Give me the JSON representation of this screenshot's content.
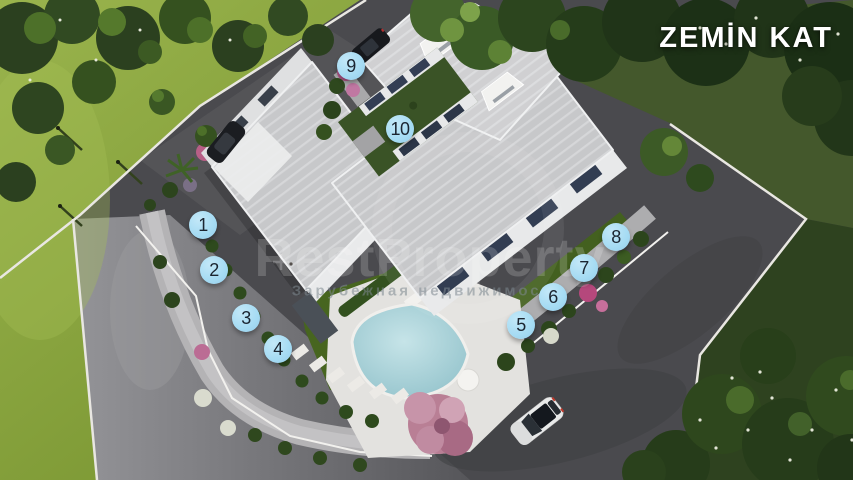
{
  "title": "ZEMİN KAT",
  "watermark": {
    "brand": "RestProperty",
    "tagline": "Зарубежная недвижимость"
  },
  "markers": [
    {
      "id": 1,
      "label": "1"
    },
    {
      "id": 2,
      "label": "2"
    },
    {
      "id": 3,
      "label": "3"
    },
    {
      "id": 4,
      "label": "4"
    },
    {
      "id": 5,
      "label": "5"
    },
    {
      "id": 6,
      "label": "6"
    },
    {
      "id": 7,
      "label": "7"
    },
    {
      "id": 8,
      "label": "8"
    },
    {
      "id": 9,
      "label": "9"
    },
    {
      "id": 10,
      "label": "10"
    }
  ],
  "colors": {
    "marker_fill": "#a5dbf3",
    "marker_text": "#1b2531",
    "title_text": "#ffffff",
    "pool_water": "#9fccd4",
    "roof": "#c8c9cb",
    "lawn": "#8aa83f",
    "road_dark": "#4a4a4e",
    "road_light": "#8f8f93"
  }
}
